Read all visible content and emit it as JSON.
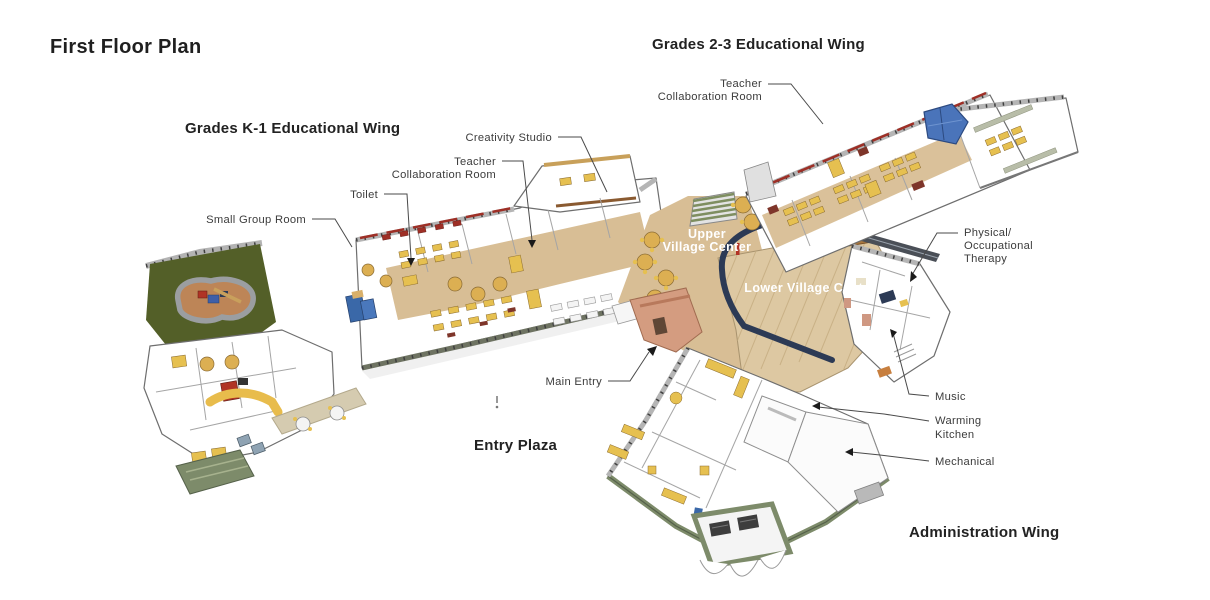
{
  "labels": {
    "title": "First Floor Plan",
    "k1_wing": "Grades K-1 Educational Wing",
    "g23_wing": "Grades 2-3 Educational Wing",
    "entry_plaza": "Entry Plaza",
    "admin_wing": "Administration Wing"
  },
  "rooms": {
    "creativity_studio": "Creativity Studio",
    "teacher_collab_k1": {
      "lines": [
        "Teacher",
        "Collaboration Room"
      ]
    },
    "teacher_collab_g23": {
      "lines": [
        "Teacher",
        "Collaboration Room"
      ]
    },
    "toilet": "Toilet",
    "small_group_room": "Small Group Room",
    "upper_village": {
      "lines": [
        "Upper",
        "Village Center"
      ]
    },
    "lower_village": "Lower Village Center",
    "physical_occupational_therapy": {
      "lines": [
        "Physical/",
        "Occupational",
        "Therapy"
      ]
    },
    "main_entry": "Main Entry",
    "music": "Music",
    "warming_kitchen": {
      "lines": [
        "Warming",
        "Kitchen"
      ]
    },
    "mechanical": "Mechanical"
  },
  "colors": {
    "carpet_tan": "#d8be95",
    "wood_floor": "#ddc8a2",
    "wood_line": "#c6ad82",
    "furniture_yellow": "#e6c050",
    "accent_red": "#9e2f26",
    "redbrown": "#7e352a",
    "bench_navy": "#2c3a55",
    "bench_beige": "#b8bda8",
    "playground_green": "#535f28",
    "play_surface": "#bd8557",
    "path_gray": "#9b9ea1",
    "sage_green": "#7d8b6a",
    "sage_dark": "#55614a",
    "entry_salmon": "#d49c80",
    "canopy_blue": "#4a74ba",
    "loft_blue": "#3a68a8",
    "table_white": "#f4f4f4",
    "table_top": "#dcaf52",
    "stair_green": "#7e8e60",
    "wood_slats": "#a8773f",
    "walk_beige": "#d5cbb0",
    "glass_blue": "#8fa3b3",
    "gray_unit": "#b9b9b9"
  }
}
